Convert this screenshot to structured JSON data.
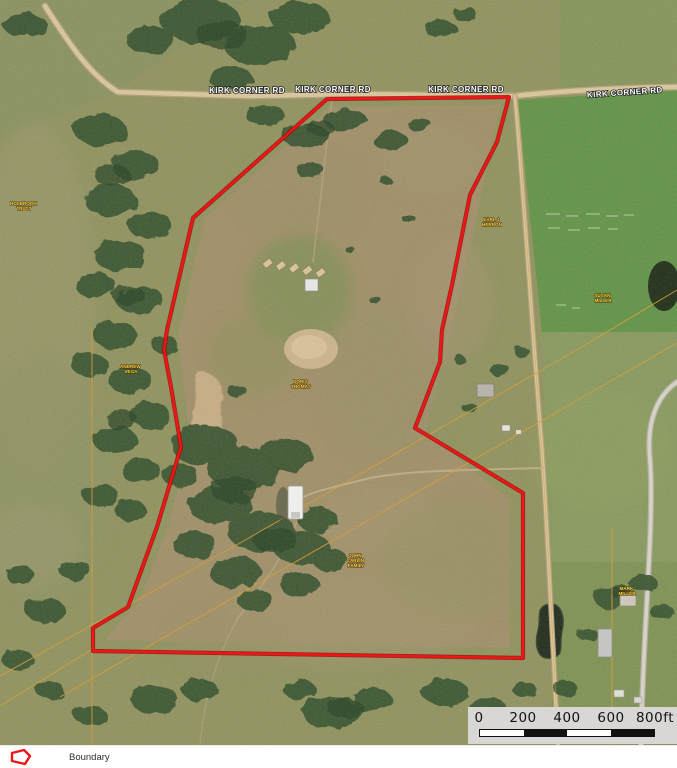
{
  "title": "Aerial parcel map",
  "colors": {
    "boundary": "#f01616",
    "parcel_line": "#d89c34",
    "road_label_fill": "#ffffff",
    "parcel_label_fill": "#ffd34d",
    "scalebar_bg": "#d8d7d3"
  },
  "map": {
    "road_label": "KIRK CORNER RD",
    "parcel_labels": [
      {
        "lines": [
          "HOLBROOK",
          "TRUST"
        ]
      },
      {
        "lines": [
          "ANDREW",
          "VEGA"
        ]
      },
      {
        "lines": [
          "DORIS",
          "THOMAS"
        ]
      },
      {
        "lines": [
          "EARL J",
          "HERRON"
        ]
      },
      {
        "lines": [
          "SUSAN",
          "MILLER"
        ]
      },
      {
        "lines": [
          "JOHN",
          "CARLIN",
          "FAMILY"
        ]
      },
      {
        "lines": [
          "MARK",
          "MILLER"
        ]
      }
    ]
  },
  "scalebar": {
    "labels": [
      "0",
      "200",
      "400",
      "600",
      "800ft"
    ]
  },
  "legend": {
    "label": "Boundary"
  }
}
